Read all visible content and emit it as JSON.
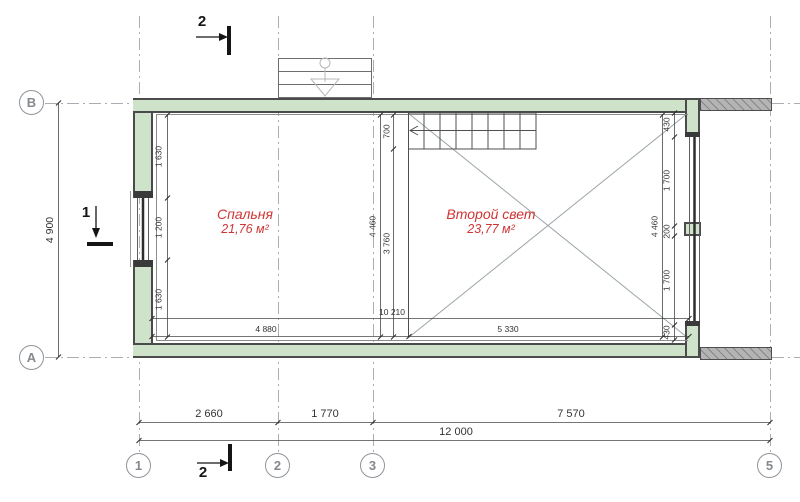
{
  "colors": {
    "wall_fill": "#cfe2ca",
    "wall_edge": "#4b4b4b",
    "annex_wall_fill": "#b4b4b4",
    "grid_line": "#a8aeb4",
    "dim_line": "#474747",
    "dim_text": "#333333",
    "room_label": "#cf3535",
    "bubble": "#8f949a"
  },
  "grid_bubbles": {
    "row_top": "В",
    "row_bottom": "А",
    "col_1": "1",
    "col_2": "2",
    "col_3": "3",
    "col_4": "5"
  },
  "section_markers": {
    "marker_2": "2",
    "marker_1": "1"
  },
  "rooms": {
    "bedroom": {
      "name": "Спальня",
      "area": "21,76 м²"
    },
    "second_light": {
      "name": "Второй свет",
      "area": "23,77 м²"
    }
  },
  "dimensions": {
    "overall_width": "12 000",
    "span_1_2": "2 660",
    "span_2_3": "1 770",
    "span_3_5": "7 570",
    "overall_depth": "4 900",
    "inner_width": "10 210",
    "bedroom_width": "4 880",
    "second_light_width": "5 330",
    "west_chain": {
      "top": "1 630",
      "window": "1 200",
      "bottom": "1 630"
    },
    "stair_landing": "700",
    "stair_to_wall": "3 760",
    "inner_depth_left": "4 460",
    "inner_depth_right": "4 460",
    "east_chain": {
      "top": "430",
      "upper": "1 700",
      "mid": "200",
      "lower": "1 700",
      "bottom": "430"
    }
  }
}
